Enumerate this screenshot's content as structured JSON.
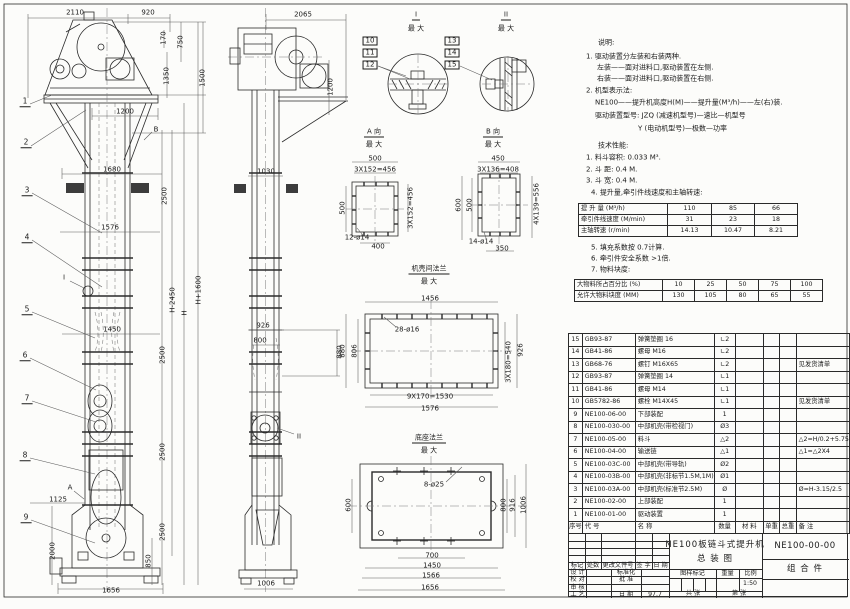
{
  "doc": {
    "drawing_title": "NE100板链斗式提升机 总装图",
    "drawing_no": "NE100-00-00",
    "scale": "1:50",
    "date": "97.7"
  },
  "annotations": [
    {
      "t": "2110",
      "x": 75,
      "y": 13
    },
    {
      "t": "920",
      "x": 148,
      "y": 13
    },
    {
      "t": "170",
      "x": 164,
      "y": 38,
      "r": 1
    },
    {
      "t": "750",
      "x": 181,
      "y": 42,
      "r": 1
    },
    {
      "t": "1350",
      "x": 167,
      "y": 76,
      "r": 1
    },
    {
      "t": "1500",
      "x": 203,
      "y": 78,
      "r": 1
    },
    {
      "t": "1200",
      "x": 125,
      "y": 112
    },
    {
      "t": "B",
      "x": 156,
      "y": 130
    },
    {
      "t": "1680",
      "x": 112,
      "y": 170
    },
    {
      "t": "2500",
      "x": 165,
      "y": 196,
      "r": 1
    },
    {
      "t": "1576",
      "x": 110,
      "y": 228
    },
    {
      "t": "H+1600",
      "x": 199,
      "y": 290,
      "r": 1
    },
    {
      "t": "H-2450",
      "x": 173,
      "y": 300,
      "r": 1
    },
    {
      "t": "H",
      "x": 185,
      "y": 313,
      "r": 1
    },
    {
      "t": "1450",
      "x": 112,
      "y": 330
    },
    {
      "t": "2500",
      "x": 163,
      "y": 355,
      "r": 1
    },
    {
      "t": "2500",
      "x": 163,
      "y": 452,
      "r": 1
    },
    {
      "t": "2500",
      "x": 163,
      "y": 532,
      "r": 1
    },
    {
      "t": "850",
      "x": 149,
      "y": 561,
      "r": 1
    },
    {
      "t": "1125",
      "x": 58,
      "y": 500
    },
    {
      "t": "2000",
      "x": 53,
      "y": 551,
      "r": 1
    },
    {
      "t": "1656",
      "x": 111,
      "y": 591
    },
    {
      "t": "A",
      "x": 70,
      "y": 488
    },
    {
      "t": "I",
      "x": 64,
      "y": 278
    },
    {
      "t": "1",
      "x": 25,
      "y": 102,
      "c": "bal"
    },
    {
      "t": "2",
      "x": 26,
      "y": 143,
      "c": "bal"
    },
    {
      "t": "3",
      "x": 27,
      "y": 191,
      "c": "bal"
    },
    {
      "t": "4",
      "x": 27,
      "y": 238,
      "c": "bal"
    },
    {
      "t": "5",
      "x": 27,
      "y": 310,
      "c": "bal"
    },
    {
      "t": "6",
      "x": 25,
      "y": 356,
      "c": "bal"
    },
    {
      "t": "7",
      "x": 27,
      "y": 399,
      "c": "bal"
    },
    {
      "t": "8",
      "x": 25,
      "y": 456,
      "c": "bal"
    },
    {
      "t": "9",
      "x": 26,
      "y": 518,
      "c": "bal"
    },
    {
      "t": "2065",
      "x": 303,
      "y": 15
    },
    {
      "t": "1200",
      "x": 331,
      "y": 87,
      "r": 1
    },
    {
      "t": "1030",
      "x": 266,
      "y": 172
    },
    {
      "t": "926",
      "x": 263,
      "y": 326
    },
    {
      "t": "800",
      "x": 260,
      "y": 341
    },
    {
      "t": "880",
      "x": 340,
      "y": 352,
      "r": 1
    },
    {
      "t": "II",
      "x": 299,
      "y": 437
    },
    {
      "t": "1006",
      "x": 266,
      "y": 584
    },
    {
      "t": "I",
      "x": 416,
      "y": 16,
      "c": "ul"
    },
    {
      "t": "最 大",
      "x": 416,
      "y": 29
    },
    {
      "t": "10",
      "x": 370,
      "y": 41,
      "c": "bbx"
    },
    {
      "t": "11",
      "x": 370,
      "y": 53,
      "c": "bbx"
    },
    {
      "t": "12",
      "x": 370,
      "y": 65,
      "c": "bbx"
    },
    {
      "t": "II",
      "x": 506,
      "y": 16,
      "c": "ul"
    },
    {
      "t": "最 大",
      "x": 506,
      "y": 29
    },
    {
      "t": "13",
      "x": 452,
      "y": 41,
      "c": "bbx"
    },
    {
      "t": "14",
      "x": 452,
      "y": 53,
      "c": "bbx"
    },
    {
      "t": "15",
      "x": 452,
      "y": 65,
      "c": "bbx"
    },
    {
      "t": "A 向",
      "x": 374,
      "y": 133,
      "c": "ul"
    },
    {
      "t": "最 大",
      "x": 374,
      "y": 145
    },
    {
      "t": "500",
      "x": 375,
      "y": 159
    },
    {
      "t": "3X152=456",
      "x": 375,
      "y": 170
    },
    {
      "t": "3X152=456",
      "x": 411,
      "y": 208,
      "r": 1
    },
    {
      "t": "500",
      "x": 343,
      "y": 208,
      "r": 1
    },
    {
      "t": "12-ø14",
      "x": 357,
      "y": 238
    },
    {
      "t": "400",
      "x": 378,
      "y": 247
    },
    {
      "t": "B 向",
      "x": 493,
      "y": 133,
      "c": "ul"
    },
    {
      "t": "最 大",
      "x": 493,
      "y": 145
    },
    {
      "t": "450",
      "x": 498,
      "y": 159
    },
    {
      "t": "3X136=408",
      "x": 498,
      "y": 170
    },
    {
      "t": "600",
      "x": 459,
      "y": 205,
      "r": 1
    },
    {
      "t": "500",
      "x": 470,
      "y": 205,
      "r": 1
    },
    {
      "t": "4X139=556",
      "x": 537,
      "y": 204,
      "r": 1
    },
    {
      "t": "14-ø14",
      "x": 481,
      "y": 242
    },
    {
      "t": "350",
      "x": 502,
      "y": 249
    },
    {
      "t": "机壳间法兰",
      "x": 429,
      "y": 270,
      "c": "ul"
    },
    {
      "t": "最 大",
      "x": 429,
      "y": 282
    },
    {
      "t": "1456",
      "x": 430,
      "y": 299
    },
    {
      "t": "28-ø16",
      "x": 407,
      "y": 330
    },
    {
      "t": "880",
      "x": 343,
      "y": 351,
      "r": 1
    },
    {
      "t": "806",
      "x": 355,
      "y": 351,
      "r": 1
    },
    {
      "t": "3X180=540",
      "x": 509,
      "y": 362,
      "r": 1
    },
    {
      "t": "926",
      "x": 521,
      "y": 350,
      "r": 1
    },
    {
      "t": "9X170=1530",
      "x": 430,
      "y": 397
    },
    {
      "t": "1576",
      "x": 430,
      "y": 409
    },
    {
      "t": "底座法兰",
      "x": 429,
      "y": 439,
      "c": "ul"
    },
    {
      "t": "最 大",
      "x": 429,
      "y": 451
    },
    {
      "t": "8-ø25",
      "x": 434,
      "y": 485
    },
    {
      "t": "600",
      "x": 349,
      "y": 505,
      "r": 1
    },
    {
      "t": "800",
      "x": 504,
      "y": 505,
      "r": 1
    },
    {
      "t": "916",
      "x": 513,
      "y": 505,
      "r": 1
    },
    {
      "t": "1006",
      "x": 524,
      "y": 505,
      "r": 1
    },
    {
      "t": "700",
      "x": 432,
      "y": 556
    },
    {
      "t": "1450",
      "x": 432,
      "y": 566
    },
    {
      "t": "1566",
      "x": 431,
      "y": 576
    },
    {
      "t": "1656",
      "x": 430,
      "y": 588
    }
  ],
  "notes": {
    "lines": [
      {
        "t": "说明:",
        "x": 598,
        "y": 43
      },
      {
        "t": "1. 驱动装置分左装和右装两种.",
        "x": 586,
        "y": 57
      },
      {
        "t": "左装——面对进料口,驱动装置在左侧.",
        "x": 597,
        "y": 68
      },
      {
        "t": "右装——面对进料口,驱动装置在右侧.",
        "x": 597,
        "y": 79
      },
      {
        "t": "2. 机型表示法:",
        "x": 586,
        "y": 91
      },
      {
        "t": "NE100——提升机高度H(M)——提升量(M³/h)——左(右)装.",
        "x": 595,
        "y": 103
      },
      {
        "t": "驱动装置型号: JZQ (减速机型号)—速比—机型号",
        "x": 595,
        "y": 116
      },
      {
        "t": "Y (电动机型号)—极数—功率",
        "x": 638,
        "y": 129
      },
      {
        "t": "技术性能:",
        "x": 598,
        "y": 146
      },
      {
        "t": "1. 料斗容积: 0.033 M³.",
        "x": 586,
        "y": 158
      },
      {
        "t": "2. 斗  距: 0.4 M.",
        "x": 586,
        "y": 170
      },
      {
        "t": "3. 斗  宽: 0.4 M.",
        "x": 586,
        "y": 181
      },
      {
        "t": "4. 提升量,牵引件线速度和主轴转速:",
        "x": 591,
        "y": 193
      },
      {
        "t": "5. 填充系数按 0.7计算.",
        "x": 591,
        "y": 248
      },
      {
        "t": "6. 牵引件安全系数 >1倍.",
        "x": 591,
        "y": 259
      },
      {
        "t": "7. 物料块度:",
        "x": 591,
        "y": 270
      }
    ]
  },
  "perf_table": {
    "x": 578,
    "y": 203,
    "cols": [
      89,
      44,
      43,
      43
    ],
    "row_h": 11,
    "rows": [
      [
        "提 升 量  (M³/h)",
        "110",
        "85",
        "66"
      ],
      [
        "牵引件线速度 (M/min)",
        "31",
        "23",
        "18"
      ],
      [
        "主轴转速 (r/min)",
        "14.13",
        "10.47",
        "8.21"
      ]
    ]
  },
  "lump_table": {
    "x": 574,
    "y": 279,
    "cols": [
      88,
      32,
      32,
      32,
      32,
      32
    ],
    "row_h": 11,
    "rows": [
      [
        "大物料所占百分比 (%)",
        "10",
        "25",
        "50",
        "75",
        "100"
      ],
      [
        "允许大物料块度 (MM)",
        "130",
        "105",
        "80",
        "65",
        "55"
      ]
    ]
  },
  "bom": {
    "x": 568,
    "y": 333,
    "cols": [
      14,
      57,
      63,
      28,
      40,
      19,
      19,
      40
    ],
    "row_h": 12.5,
    "rows": [
      [
        "15",
        "GB93-87",
        "弹簧垫圈 16",
        "∟2",
        "",
        "",
        "",
        ""
      ],
      [
        "14",
        "GB41-86",
        "螺母 M16",
        "∟2",
        "",
        "",
        "",
        ""
      ],
      [
        "13",
        "GB68-76",
        "螺钉 M16X65",
        "∟2",
        "",
        "",
        "",
        "见发货清单"
      ],
      [
        "12",
        "GB93-87",
        "弹簧垫圈 14",
        "∟1",
        "",
        "",
        "",
        ""
      ],
      [
        "11",
        "GB41-86",
        "螺母 M14",
        "∟1",
        "",
        "",
        "",
        ""
      ],
      [
        "10",
        "GB5782-86",
        "螺栓 M14X45",
        "∟1",
        "",
        "",
        "",
        "见发货清单"
      ],
      [
        "9",
        "NE100-06-00",
        "下部装配",
        "1",
        "",
        "",
        "",
        ""
      ],
      [
        "8",
        "NE100-030-00",
        "中部机壳(带检视门)",
        "Ø3",
        "",
        "",
        "",
        ""
      ],
      [
        "7",
        "NE100-05-00",
        "料斗",
        "△2",
        "",
        "",
        "",
        "△2=H/0.2+5.75"
      ],
      [
        "6",
        "NE100-04-00",
        "输送链",
        "△1",
        "",
        "",
        "",
        "△1=△2X4"
      ],
      [
        "5",
        "NE100-03C-00",
        "中部机壳(带导轨)",
        "Ø2",
        "",
        "",
        "",
        ""
      ],
      [
        "4",
        "NE100-03B-00",
        "中部机壳(非标节1.5M,1M)",
        "Ø1",
        "",
        "",
        "",
        ""
      ],
      [
        "3",
        "NE100-03A-00",
        "中部机壳(标准节2.5M)",
        "Ø",
        "",
        "",
        "",
        "Ø=H-3.15/2.5"
      ],
      [
        "2",
        "NE100-02-00",
        "上部装配",
        "1",
        "",
        "",
        "",
        ""
      ],
      [
        "1",
        "NE100-01-00",
        "驱动装置",
        "1",
        "",
        "",
        "",
        ""
      ],
      [
        "序号",
        "代  号",
        "名  称",
        "数量",
        "材  料",
        "单重",
        "总重",
        "备  注"
      ]
    ]
  },
  "title_block": {
    "product": "NE100板链斗式提升机",
    "drawing_name": "总  装  图",
    "drawing_no": "NE100-00-00",
    "part_type": "组 合 件",
    "rev_header": [
      "标记",
      "处数",
      "更改文件号",
      "签 字",
      "日 期"
    ],
    "left_rows": [
      [
        "设 计",
        "",
        "标准化",
        ""
      ],
      [
        "校 对",
        "",
        "批 准",
        ""
      ],
      [
        "审 核",
        "",
        "",
        ""
      ],
      [
        "工 艺",
        "",
        "日 期",
        "97.7"
      ]
    ],
    "stamp_header": [
      "图样标记",
      "重量",
      "比例"
    ],
    "scale": "1:50",
    "sheet_total": "共   张",
    "sheet_no": "第   张"
  }
}
